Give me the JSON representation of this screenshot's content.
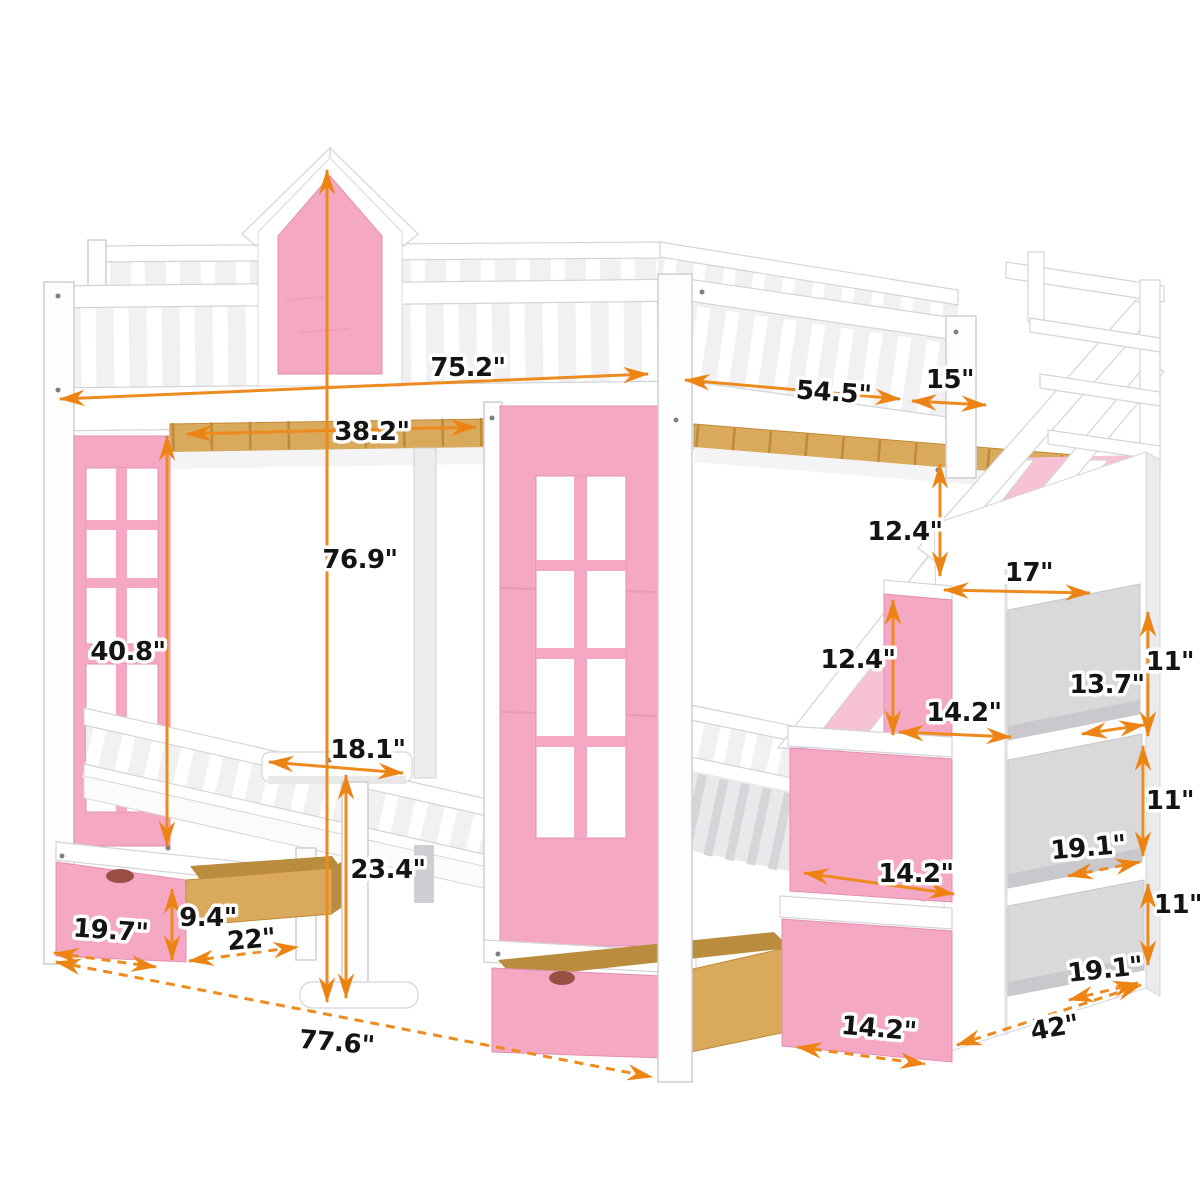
{
  "diagram": {
    "subject": "kids bunk loft bed with castle tower, table, storage staircase and drawers",
    "units": "inches"
  },
  "colors": {
    "accent_orange": "#ED8B1E",
    "arrow_head": "#ED8313",
    "pink_panel": "#F5A8C4",
    "pink_light": "#F8C2D5",
    "wood_tan": "#D9A95C",
    "structure_white": "#FFFFFF",
    "shade_gray": "#E9E9EC",
    "cubby_gray": "#D9D9DC",
    "label_text": "#141414"
  },
  "dimensions": [
    {
      "name": "loft-length",
      "label": "75.2\""
    },
    {
      "name": "loft-depth",
      "label": "54.5\""
    },
    {
      "name": "stair-landing-width",
      "label": "15\""
    },
    {
      "name": "under-loft-width",
      "label": "38.2\""
    },
    {
      "name": "total-height",
      "label": "76.9\""
    },
    {
      "name": "under-loft-height",
      "label": "40.8\""
    },
    {
      "name": "stair-upper-rise",
      "label": "12.4\""
    },
    {
      "name": "stair-top-depth",
      "label": "17\""
    },
    {
      "name": "stair-mid-rise",
      "label": "12.4\""
    },
    {
      "name": "stair-tread-width",
      "label": "14.2\""
    },
    {
      "name": "cubby-top-width",
      "label": "13.7\""
    },
    {
      "name": "cubby-top-height",
      "label": "11\""
    },
    {
      "name": "table-top-width",
      "label": "18.1\""
    },
    {
      "name": "table-height",
      "label": "23.4\""
    },
    {
      "name": "stair-step-front-width",
      "label": "14.2\""
    },
    {
      "name": "cubby-mid-width",
      "label": "19.1\""
    },
    {
      "name": "cubby-mid-height",
      "label": "11\""
    },
    {
      "name": "drawer-front-width",
      "label": "19.7\""
    },
    {
      "name": "drawer-height",
      "label": "9.4\""
    },
    {
      "name": "drawer-depth",
      "label": "22\""
    },
    {
      "name": "total-length",
      "label": "77.6\""
    },
    {
      "name": "bottom-step-width",
      "label": "14.2\""
    },
    {
      "name": "staircase-total-depth",
      "label": "42\""
    },
    {
      "name": "cubby-bottom-width",
      "label": "19.1\""
    },
    {
      "name": "cubby-bottom-height",
      "label": "11\""
    }
  ]
}
